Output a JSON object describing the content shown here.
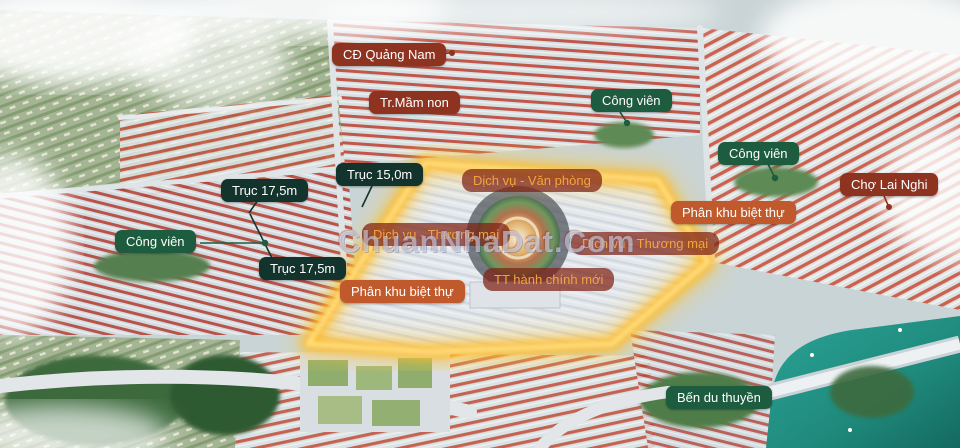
{
  "scene": {
    "description": "Aerial 3D masterplan render of an urban residential project with highlighted boundary",
    "watermark": "ChuanNhaDat.Com"
  },
  "palette": {
    "label_maroon": "#8e3320",
    "label_green": "#1d5c3e",
    "label_teal": "#13332d",
    "label_orange": "#c05a2c",
    "label_overlay_bg": "rgba(125,32,18,0.72)",
    "label_overlay_text": "#f4a43e",
    "boundary_glow": "#ffc83a",
    "water": "#1f8a7d",
    "roof_red": "#c34f39"
  },
  "labels": [
    {
      "id": "cd-quang-nam",
      "text": "CĐ Quảng Nam",
      "style": "maroon"
    },
    {
      "id": "tr-mam-non",
      "text": "Tr.Mầm non",
      "style": "maroon"
    },
    {
      "id": "cong-vien-top",
      "text": "Công viên",
      "style": "green"
    },
    {
      "id": "cong-vien-right",
      "text": "Công viên",
      "style": "green"
    },
    {
      "id": "cho-lai-nghi",
      "text": "Chợ Lai Nghi",
      "style": "maroon"
    },
    {
      "id": "phan-khu-biet-thu-right",
      "text": "Phân khu biệt thự",
      "style": "orange"
    },
    {
      "id": "truc-15-0m",
      "text": "Trục 15,0m",
      "style": "teal"
    },
    {
      "id": "truc-17-5m-upper",
      "text": "Trục 17,5m",
      "style": "teal"
    },
    {
      "id": "cong-vien-left",
      "text": "Công viên",
      "style": "green"
    },
    {
      "id": "truc-17-5m-lower",
      "text": "Trục 17,5m",
      "style": "teal"
    },
    {
      "id": "dich-vu-van-phong",
      "text": "Dịch vụ - Văn phòng",
      "style": "overlay"
    },
    {
      "id": "dich-vu-thuong-mai-left",
      "text": "Dịch vụ - Thương mại",
      "style": "overlay"
    },
    {
      "id": "dich-vu-thuong-mai-right",
      "text": "Dịch vụ - Thương mại",
      "style": "overlay"
    },
    {
      "id": "tt-hanh-chinh-moi",
      "text": "TT hành chính mới",
      "style": "overlay"
    },
    {
      "id": "phan-khu-biet-thu-left",
      "text": "Phân khu biệt thự",
      "style": "orange"
    },
    {
      "id": "ben-du-thuyen",
      "text": "Bến du thuyền",
      "style": "green"
    }
  ]
}
